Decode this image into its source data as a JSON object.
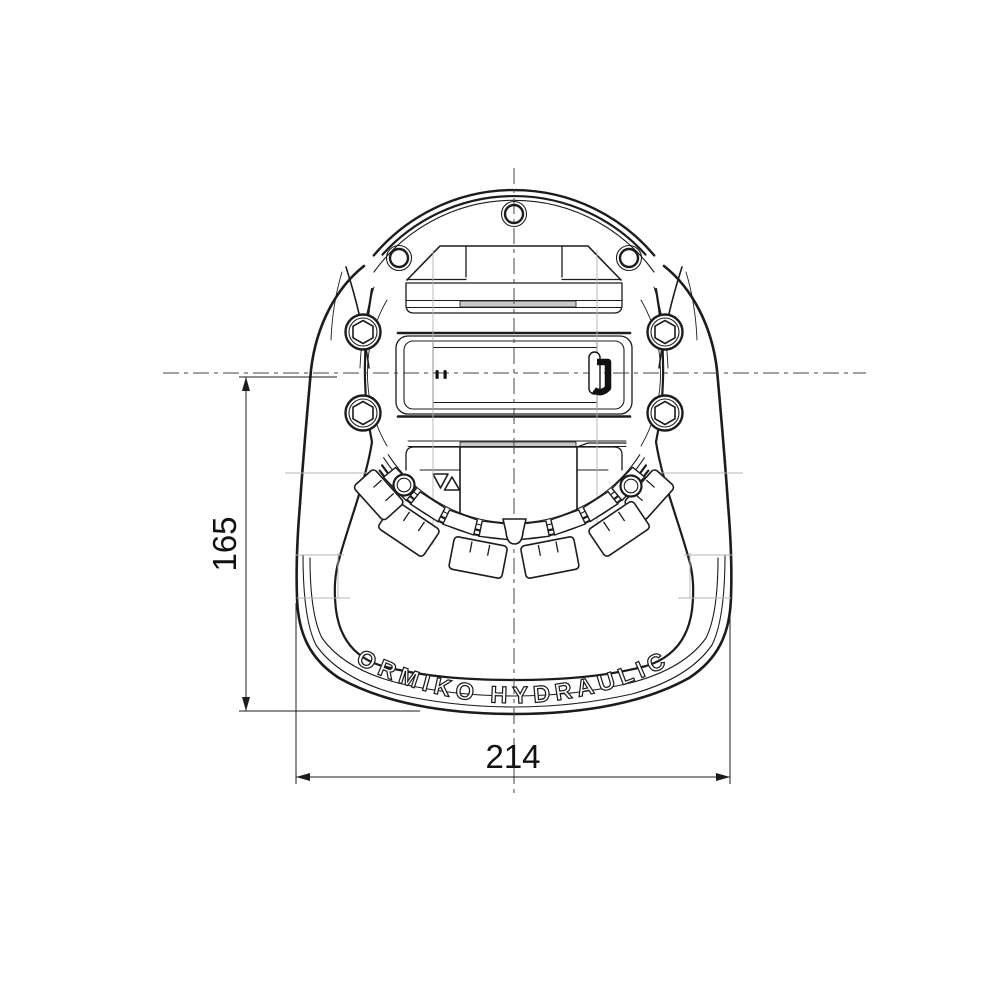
{
  "drawing": {
    "title": "hydraulic clamp housing front view",
    "brand_text": "FORMIKO HYDRAULICS",
    "dim_height": "165",
    "dim_width": "214",
    "symbols": {
      "triangle_down": "▽",
      "triangle_up": "△"
    },
    "colors": {
      "line": "#1c1c1c",
      "construction": "#b4b4b4",
      "paper": "#ffffff",
      "strip": "#c9c9c9",
      "detail_black": "#111111"
    }
  }
}
